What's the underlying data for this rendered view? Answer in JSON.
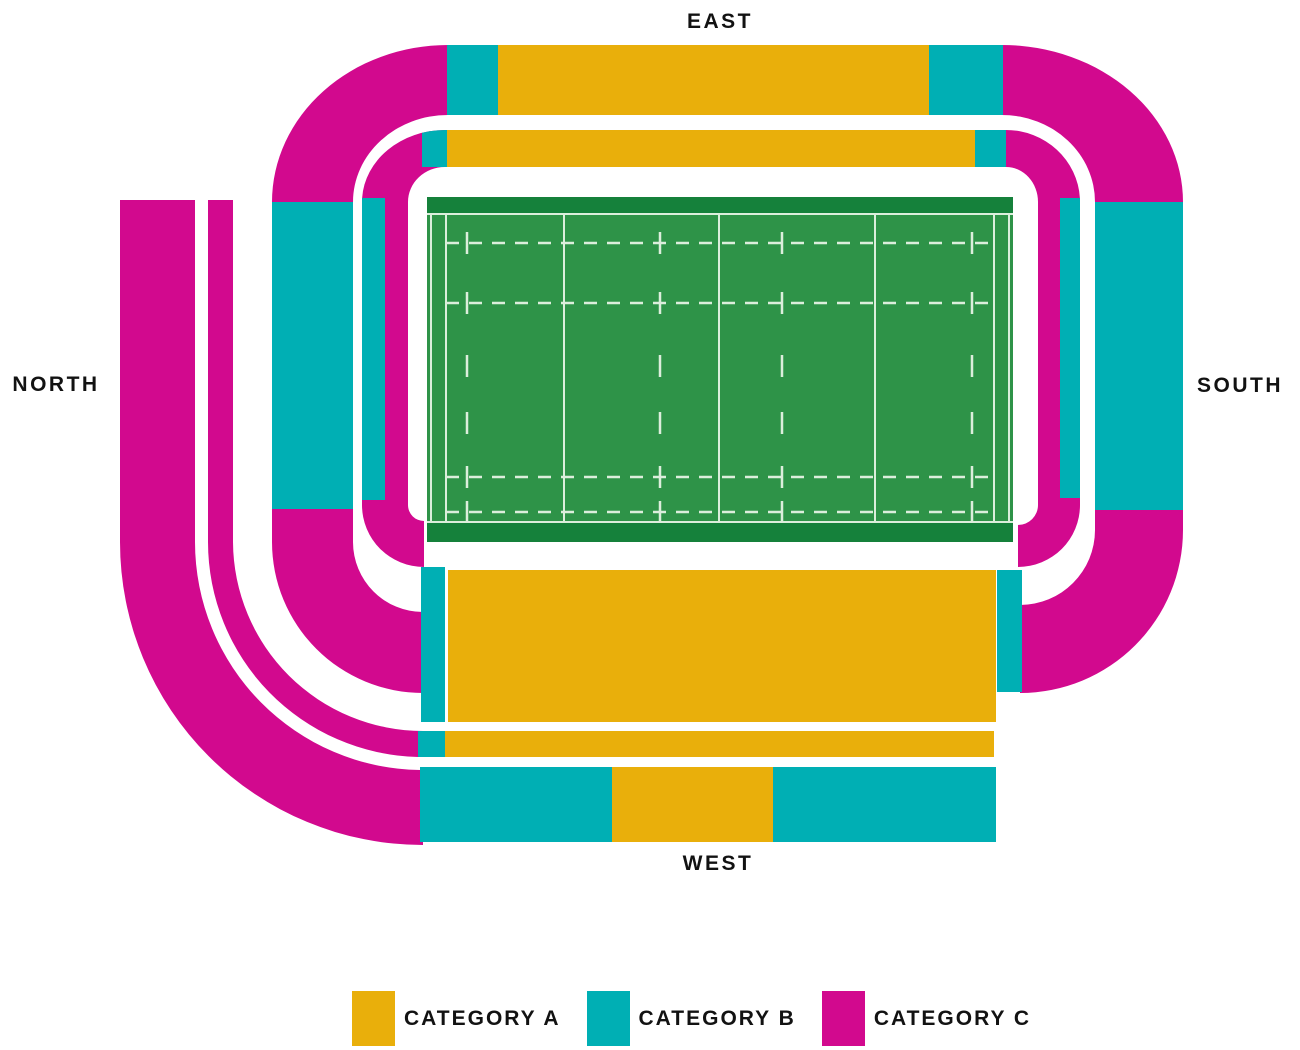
{
  "title": "Stadium seating map",
  "labels": {
    "north": "NORTH",
    "south": "SOUTH",
    "east": "EAST",
    "west": "WEST"
  },
  "legend": [
    {
      "label": "CATEGORY A",
      "color": "#E9AF0B"
    },
    {
      "label": "CATEGORY B",
      "color": "#00AFB4"
    },
    {
      "label": "CATEGORY C",
      "color": "#D2098E"
    }
  ],
  "colors": {
    "category_a": "#E9AF0B",
    "category_b": "#00AFB4",
    "category_c": "#D2098E",
    "pitch_green": "#2E9348",
    "pitch_dark_green": "#15813B",
    "pitch_line": "#DCEEDC",
    "background": "#FFFFFF",
    "label_text": "#121212"
  },
  "stands": {
    "east_inner_tier": [
      "B",
      "A",
      "B"
    ],
    "east_outer_tier": [
      "B",
      "A",
      "B"
    ],
    "north_inner_tier": [
      "B",
      "C"
    ],
    "north_middle_tier": [
      "B"
    ],
    "north_outer_tier": [
      "C",
      "C"
    ],
    "south_inner_tier": [
      "C",
      "B"
    ],
    "south_outer_tier": [
      "B"
    ],
    "west_inner_tier": [
      "B",
      "A",
      "B"
    ],
    "west_middle_tier": [
      "B",
      "A"
    ],
    "west_outer_tier": [
      "B",
      "A",
      "B"
    ],
    "corners": "C"
  }
}
